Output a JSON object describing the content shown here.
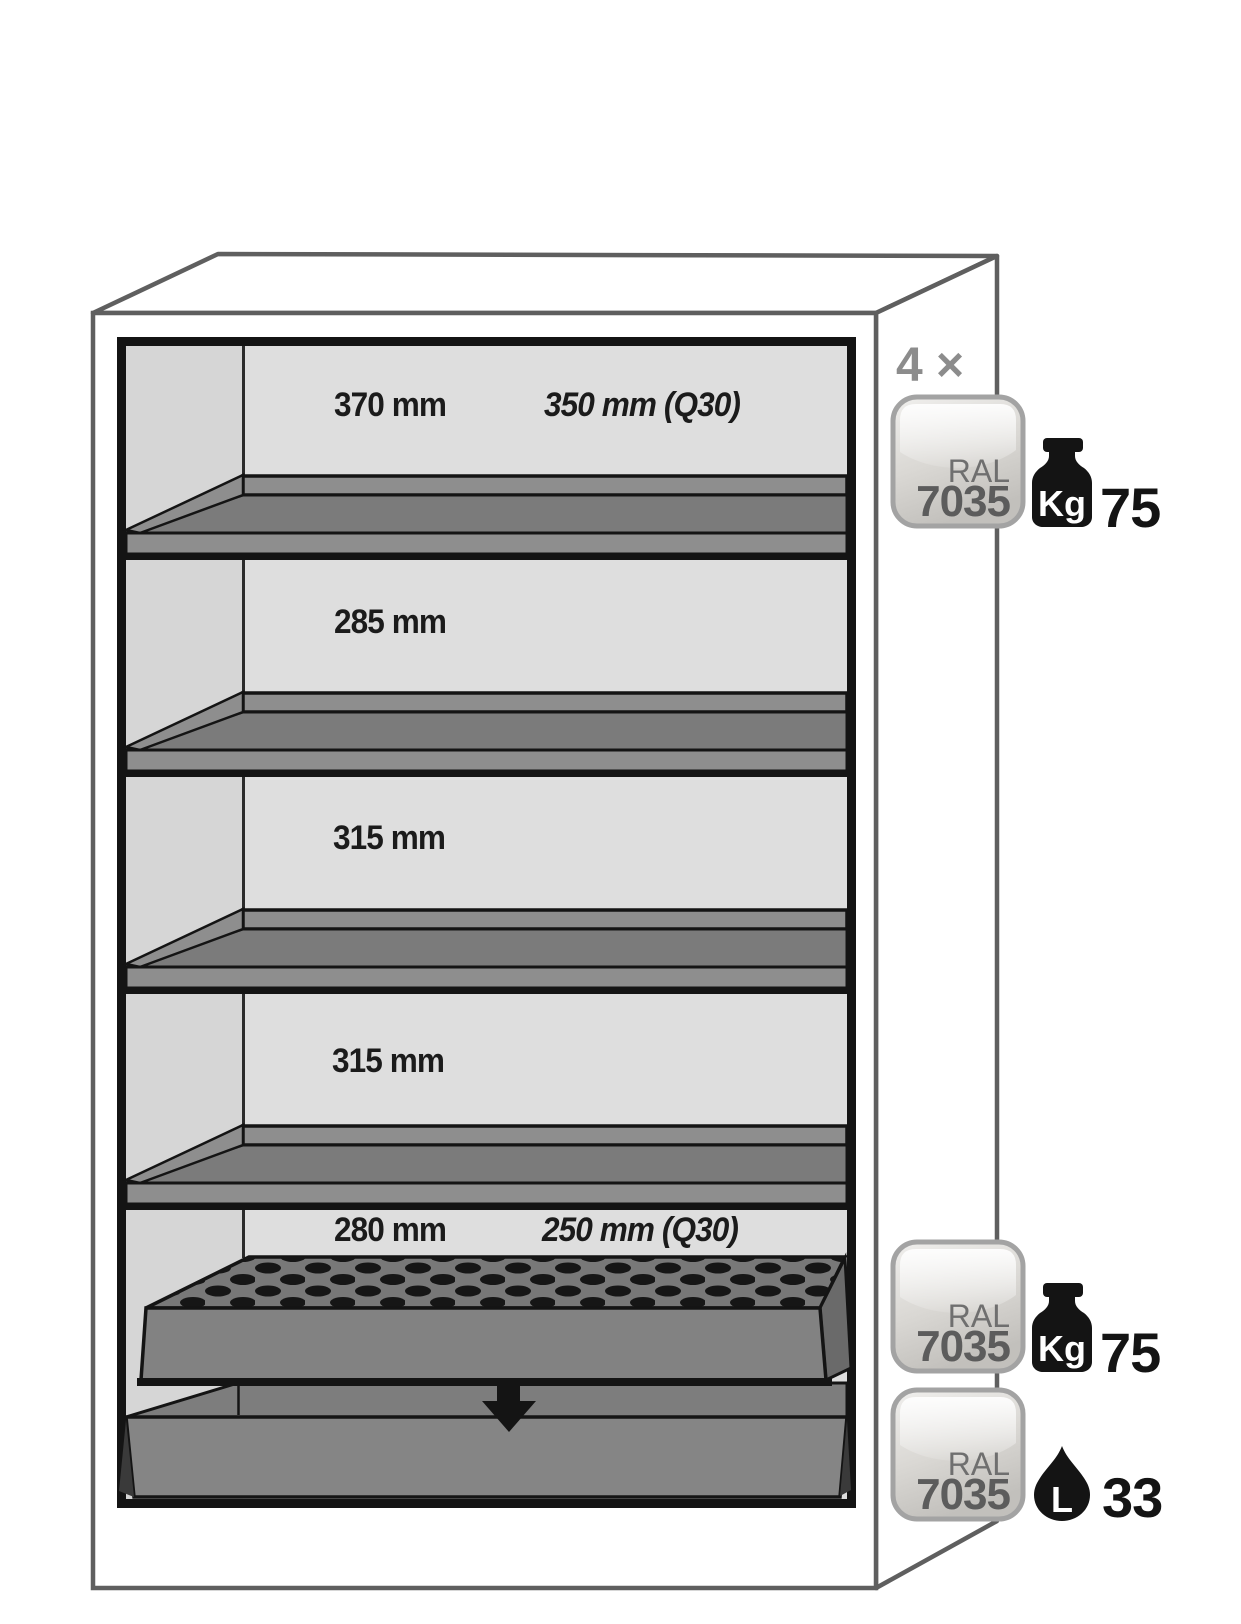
{
  "figure": {
    "type": "safety-cabinet-interior-dimension-diagram",
    "compartments": [
      {
        "depth": "370 mm",
        "depth_q30": "350 mm (Q30)"
      },
      {
        "depth": "285 mm"
      },
      {
        "depth": "315 mm"
      },
      {
        "depth": "315 mm"
      },
      {
        "depth": "280 mm",
        "depth_q30": "250 mm (Q30)"
      }
    ],
    "shelf_count_label": "4 ×",
    "legend_rows": [
      {
        "badge_top": "RAL",
        "badge_bottom": "7035",
        "icon": "weight-kg-icon",
        "icon_label": "Kg",
        "value": "75"
      },
      {
        "badge_top": "RAL",
        "badge_bottom": "7035",
        "icon": "weight-kg-icon",
        "icon_label": "Kg",
        "value": "75"
      },
      {
        "badge_top": "RAL",
        "badge_bottom": "7035",
        "icon": "liter-drop-icon",
        "icon_label": "L",
        "value": "33"
      }
    ],
    "colors": {
      "interior_gray": "#dedede",
      "left_wall_gray": "#d6d6d6",
      "shelf_gray": "#7b7b7b",
      "shelf_edge_gray": "#8e8e8e",
      "perforated_gray": "#787878",
      "insert_front_gray": "#828282",
      "tray_gray": "#858585",
      "outline_gray": "#5f5f5f",
      "ink": "#141414",
      "badge_border": "#a3a3a3",
      "label_gray": "#8c8c8c"
    }
  }
}
